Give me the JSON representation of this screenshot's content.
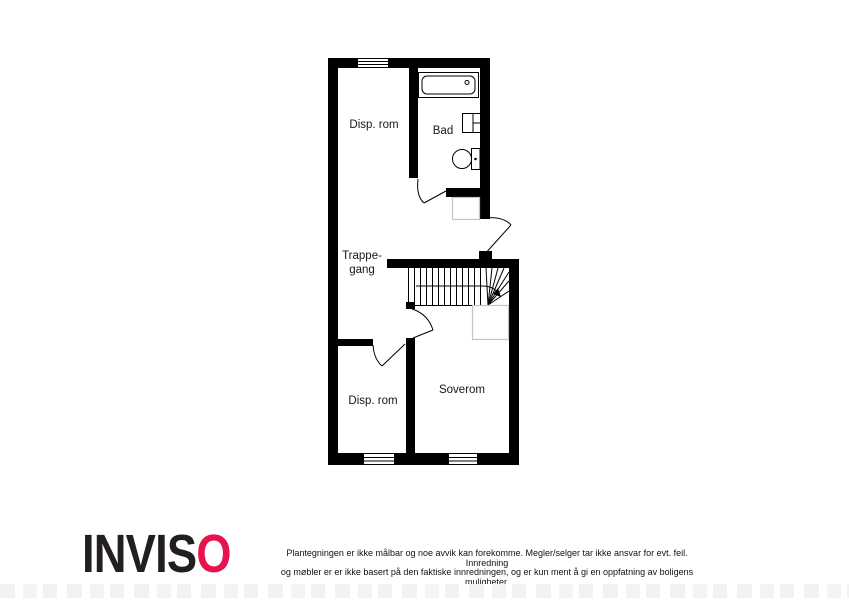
{
  "floorplan": {
    "rooms": {
      "disp_rom_upper": {
        "label": "Disp. rom"
      },
      "bad": {
        "label": "Bad"
      },
      "trappegang": {
        "line1": "Trappe-",
        "line2": "gang"
      },
      "disp_rom_lower": {
        "label": "Disp. rom"
      },
      "soverom": {
        "label": "Soverom"
      }
    },
    "fixtures": [
      "bathtub-icon",
      "sink-icon",
      "toilet-icon",
      "staircase-icon",
      "door-swing-icon",
      "window-icon"
    ],
    "wall_color": "#000000",
    "furniture_outline_color": "#c4c4c4"
  },
  "footer": {
    "logo": {
      "dark_text": "INVIS",
      "accent_text": "O",
      "dark_color": "#231f20",
      "accent_color": "#e8134c"
    },
    "disclaimer_line1": "Plantegningen er ikke målbar og noe avvik kan forekomme. Megler/selger tar ikke ansvar for evt. feil. Innredning",
    "disclaimer_line2": "og møbler er er ikke basert på den faktiske innredningen, og er kun ment å gi en oppfatning av boligens muligheter."
  }
}
